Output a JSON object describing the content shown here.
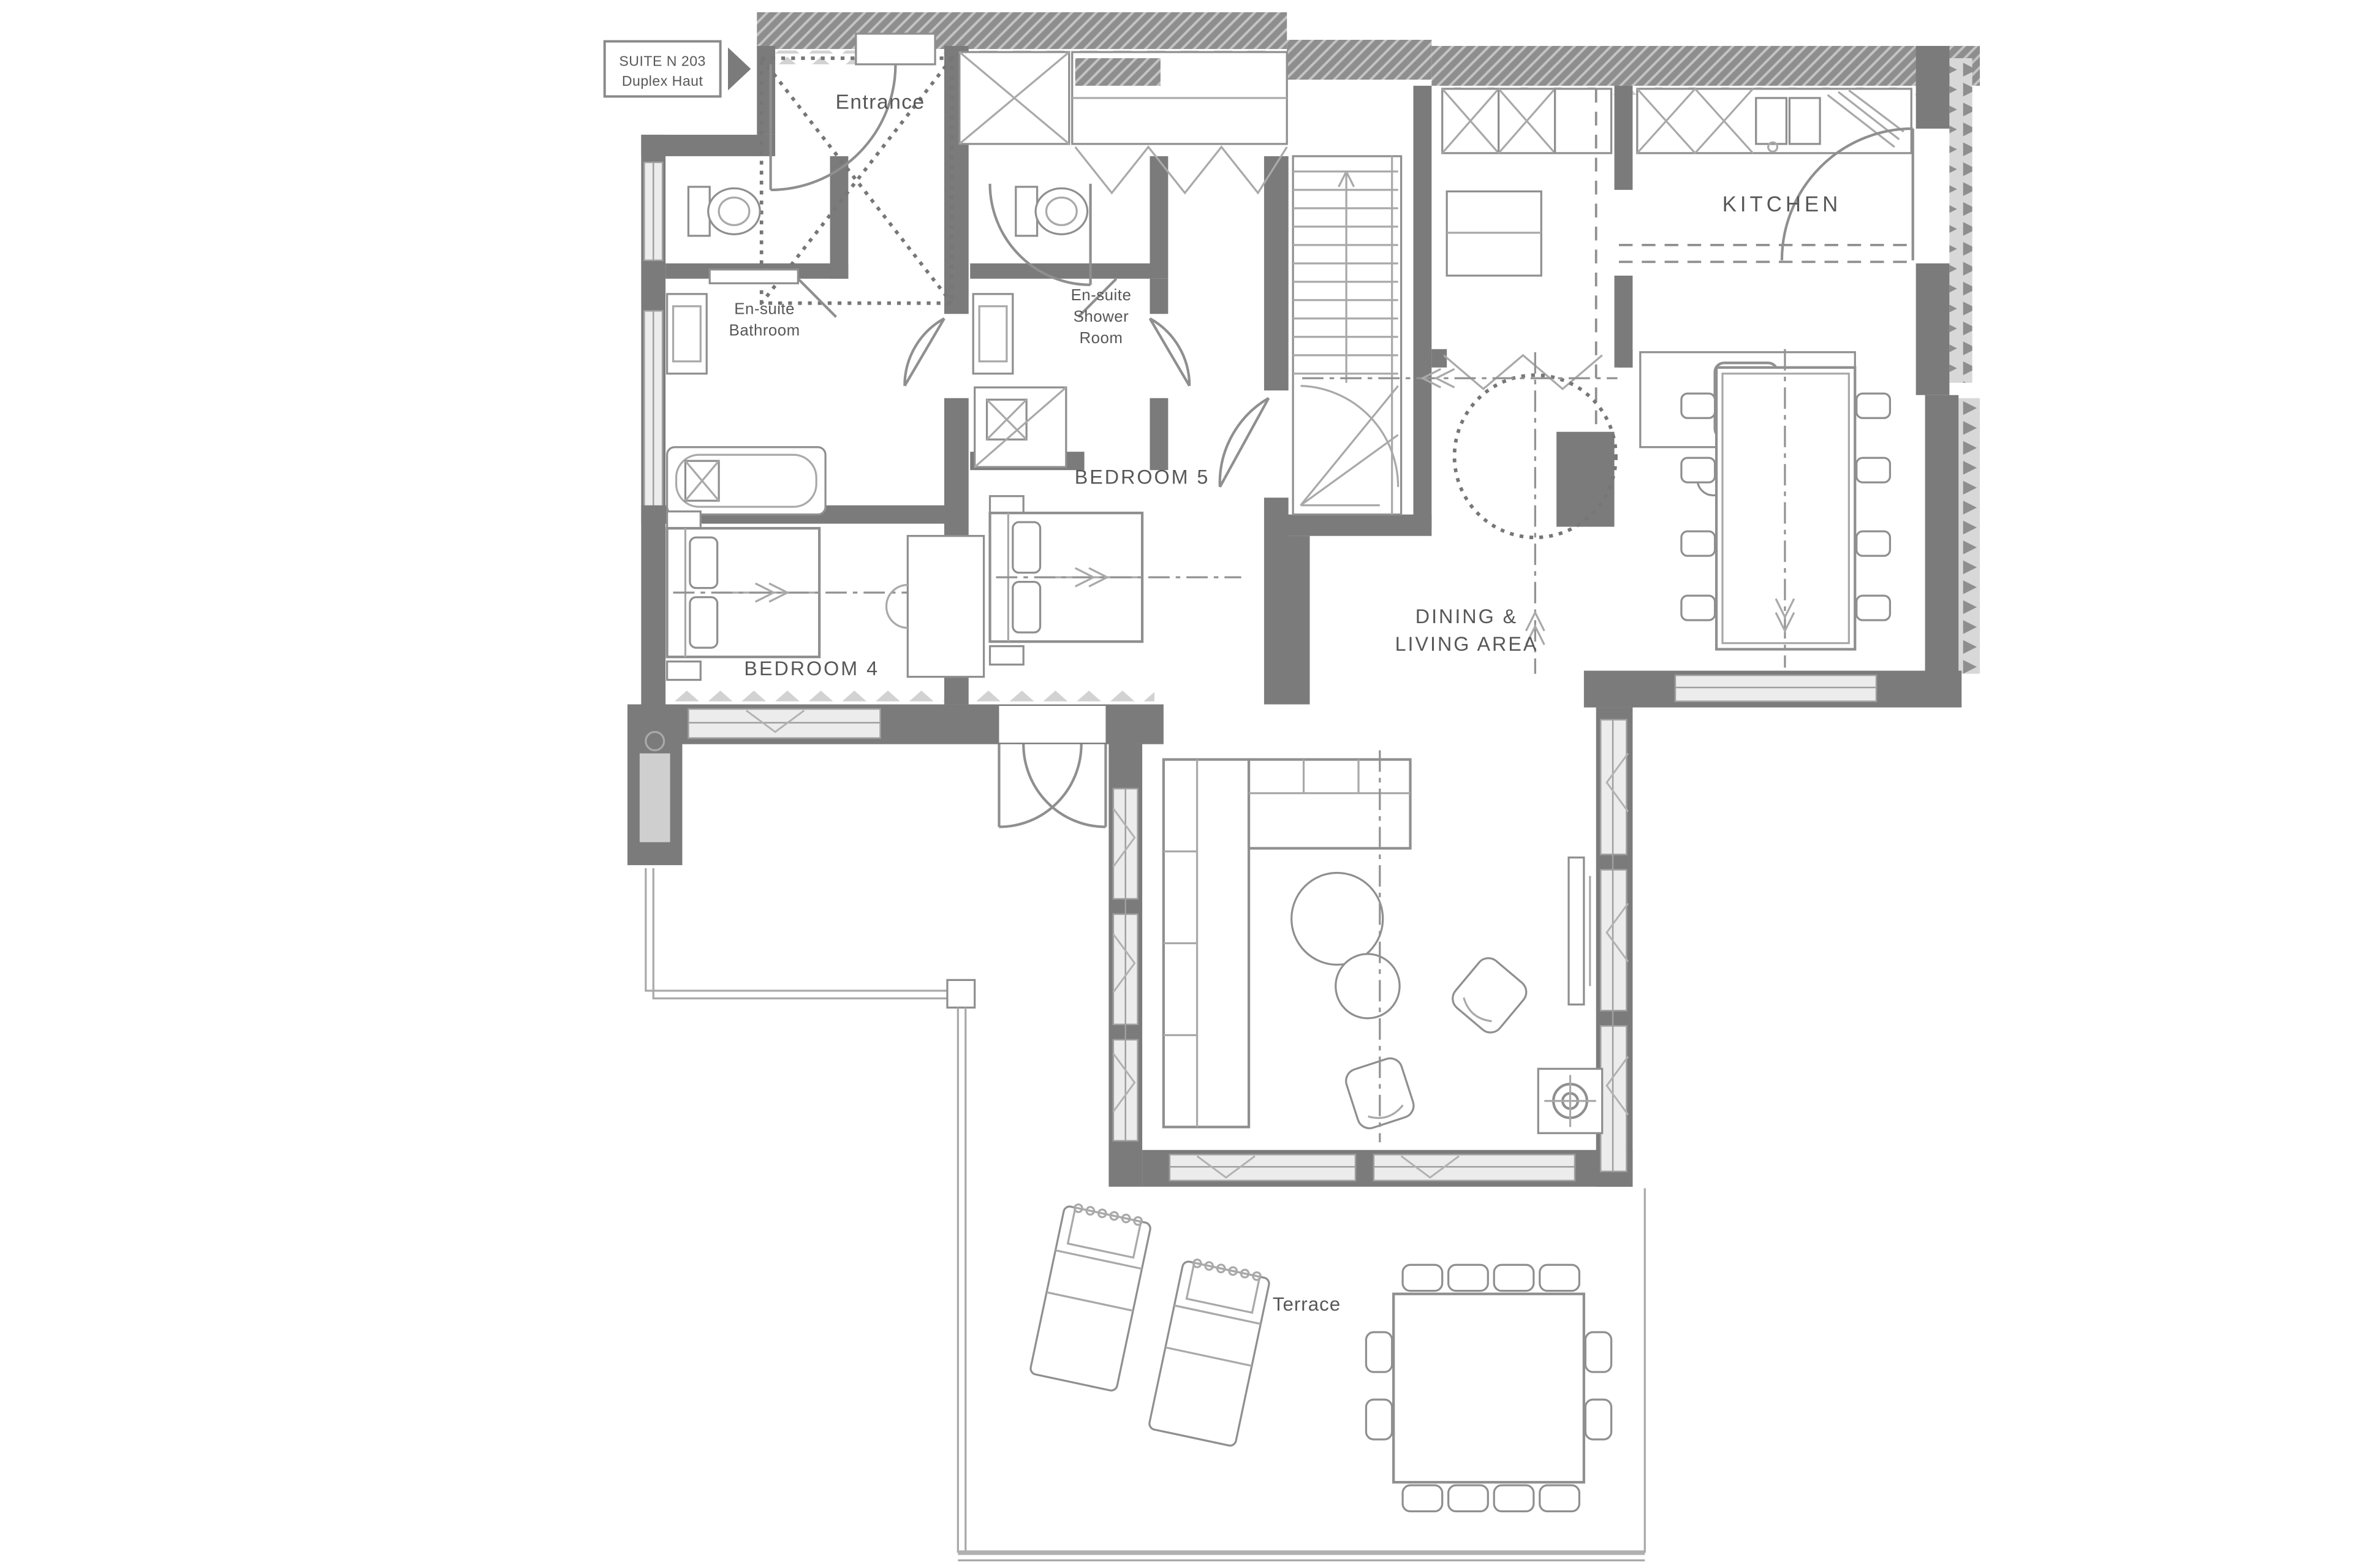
{
  "plan": {
    "suite_label": {
      "line1": "SUITE N 203",
      "line2": "Duplex Haut"
    },
    "labels": {
      "entrance": "Entrance",
      "ensuite_bathroom_line1": "En-suite",
      "ensuite_bathroom_line2": "Bathroom",
      "ensuite_shower_line1": "En-suite",
      "ensuite_shower_line2": "Shower",
      "ensuite_shower_line3": "Room",
      "bedroom5": "BEDROOM 5",
      "bedroom4": "BEDROOM 4",
      "kitchen": "KITCHEN",
      "dining_line1": "DINING &",
      "dining_line2": "LIVING AREA",
      "terrace": "Terrace"
    },
    "colors": {
      "background": "#ffffff",
      "wall": "#7b7b7b",
      "wall_hatch": "#8e8e8e",
      "window": "#ececec",
      "furniture_line": "#8f8f8f",
      "text": "#575757"
    }
  }
}
